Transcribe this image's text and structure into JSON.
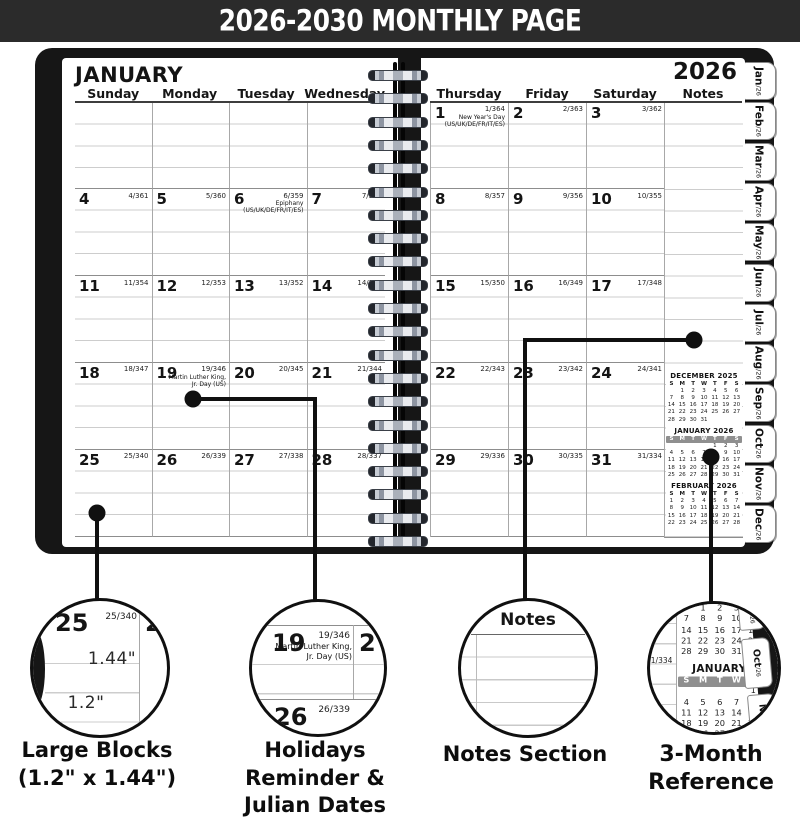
{
  "banner": {
    "title": "2026-2030 MONTHLY PAGE"
  },
  "left_page": {
    "month_title": "JANUARY",
    "day_headers": [
      "Sunday",
      "Monday",
      "Tuesday",
      "Wednesday"
    ],
    "weeks": [
      [
        null,
        null,
        null,
        null
      ],
      [
        {
          "day": "4",
          "julian": "4/361"
        },
        {
          "day": "5",
          "julian": "5/360"
        },
        {
          "day": "6",
          "julian": "6/359",
          "holiday": [
            "Epiphany",
            "(US/UK/DE/FR/IT/ES)"
          ]
        },
        {
          "day": "7",
          "julian": "7/358"
        }
      ],
      [
        {
          "day": "11",
          "julian": "11/354"
        },
        {
          "day": "12",
          "julian": "12/353"
        },
        {
          "day": "13",
          "julian": "13/352"
        },
        {
          "day": "14",
          "julian": "14/351"
        }
      ],
      [
        {
          "day": "18",
          "julian": "18/347"
        },
        {
          "day": "19",
          "julian": "19/346",
          "holiday": [
            "Martin Luther King,",
            "Jr. Day  (US)"
          ]
        },
        {
          "day": "20",
          "julian": "20/345"
        },
        {
          "day": "21",
          "julian": "21/344"
        }
      ],
      [
        {
          "day": "25",
          "julian": "25/340"
        },
        {
          "day": "26",
          "julian": "26/339"
        },
        {
          "day": "27",
          "julian": "27/338"
        },
        {
          "day": "28",
          "julian": "28/337"
        }
      ]
    ]
  },
  "right_page": {
    "year": "2026",
    "day_headers": [
      "Thursday",
      "Friday",
      "Saturday",
      "Notes"
    ],
    "weeks": [
      [
        {
          "day": "1",
          "julian": "1/364",
          "holiday": [
            "New Year's Day",
            "(US/UK/DE/FR/IT/ES)"
          ]
        },
        {
          "day": "2",
          "julian": "2/363"
        },
        {
          "day": "3",
          "julian": "3/362"
        }
      ],
      [
        {
          "day": "8",
          "julian": "8/357"
        },
        {
          "day": "9",
          "julian": "9/356"
        },
        {
          "day": "10",
          "julian": "10/355"
        }
      ],
      [
        {
          "day": "15",
          "julian": "15/350"
        },
        {
          "day": "16",
          "julian": "16/349"
        },
        {
          "day": "17",
          "julian": "17/348"
        }
      ],
      [
        {
          "day": "22",
          "julian": "22/343"
        },
        {
          "day": "23",
          "julian": "23/342"
        },
        {
          "day": "24",
          "julian": "24/341"
        }
      ],
      [
        {
          "day": "29",
          "julian": "29/336"
        },
        {
          "day": "30",
          "julian": "30/335"
        },
        {
          "day": "31",
          "julian": "31/334"
        }
      ]
    ],
    "minicals": [
      {
        "title": "DECEMBER  2025",
        "dow": [
          "S",
          "M",
          "T",
          "W",
          "T",
          "F",
          "S"
        ],
        "highlight": false,
        "weeks": [
          [
            "",
            "1",
            "2",
            "3",
            "4",
            "5",
            "6"
          ],
          [
            "7",
            "8",
            "9",
            "10",
            "11",
            "12",
            "13"
          ],
          [
            "14",
            "15",
            "16",
            "17",
            "18",
            "19",
            "20"
          ],
          [
            "21",
            "22",
            "23",
            "24",
            "25",
            "26",
            "27"
          ],
          [
            "28",
            "29",
            "30",
            "31",
            "",
            "",
            ""
          ]
        ]
      },
      {
        "title": "JANUARY  2026",
        "dow": [
          "S",
          "M",
          "T",
          "W",
          "T",
          "F",
          "S"
        ],
        "highlight": true,
        "weeks": [
          [
            "",
            "",
            "",
            "",
            "1",
            "2",
            "3"
          ],
          [
            "4",
            "5",
            "6",
            "7",
            "8",
            "9",
            "10"
          ],
          [
            "11",
            "12",
            "13",
            "14",
            "15",
            "16",
            "17"
          ],
          [
            "18",
            "19",
            "20",
            "21",
            "22",
            "23",
            "24"
          ],
          [
            "25",
            "26",
            "27",
            "28",
            "29",
            "30",
            "31"
          ]
        ]
      },
      {
        "title": "FEBRUARY  2026",
        "dow": [
          "S",
          "M",
          "T",
          "W",
          "T",
          "F",
          "S"
        ],
        "highlight": false,
        "weeks": [
          [
            "1",
            "2",
            "3",
            "4",
            "5",
            "6",
            "7"
          ],
          [
            "8",
            "9",
            "10",
            "11",
            "12",
            "13",
            "14"
          ],
          [
            "15",
            "16",
            "17",
            "18",
            "19",
            "20",
            "21"
          ],
          [
            "22",
            "23",
            "24",
            "25",
            "26",
            "27",
            "28"
          ]
        ]
      }
    ]
  },
  "tabs": [
    {
      "month": "Jan",
      "suffix": "/26"
    },
    {
      "month": "Feb",
      "suffix": "/26"
    },
    {
      "month": "Mar",
      "suffix": "/26"
    },
    {
      "month": "Apr",
      "suffix": "/26"
    },
    {
      "month": "May",
      "suffix": "/26"
    },
    {
      "month": "Jun",
      "suffix": "/26"
    },
    {
      "month": "Jul",
      "suffix": "/26"
    },
    {
      "month": "Aug",
      "suffix": "/26"
    },
    {
      "month": "Sep",
      "suffix": "/26"
    },
    {
      "month": "Oct",
      "suffix": "/26"
    },
    {
      "month": "Nov",
      "suffix": "/26"
    },
    {
      "month": "Dec",
      "suffix": "/26"
    }
  ],
  "circles": {
    "large_blocks": {
      "day": "25",
      "julian": "25/340",
      "right_fragment": "2",
      "height_label": "1.44\"",
      "width_label": "1.2\""
    },
    "holidays": {
      "left_fragment": "7",
      "day": "19",
      "julian": "19/346",
      "holiday_lines": [
        "Martin Luther King,",
        "Jr. Day  (US)"
      ],
      "right_fragment": "2",
      "below_day": "26",
      "below_julian": "26/339"
    },
    "notes": {
      "header": "Notes"
    },
    "reference": {
      "julian_fragment": "31/334"
    }
  },
  "captions": [
    {
      "lines": [
        "Large Blocks",
        "(1.2\" x 1.44\")"
      ]
    },
    {
      "lines": [
        "Holidays Reminder &",
        "Julian Dates"
      ]
    },
    {
      "lines": [
        "Notes Section"
      ]
    },
    {
      "lines": [
        "3-Month Reference"
      ]
    }
  ]
}
